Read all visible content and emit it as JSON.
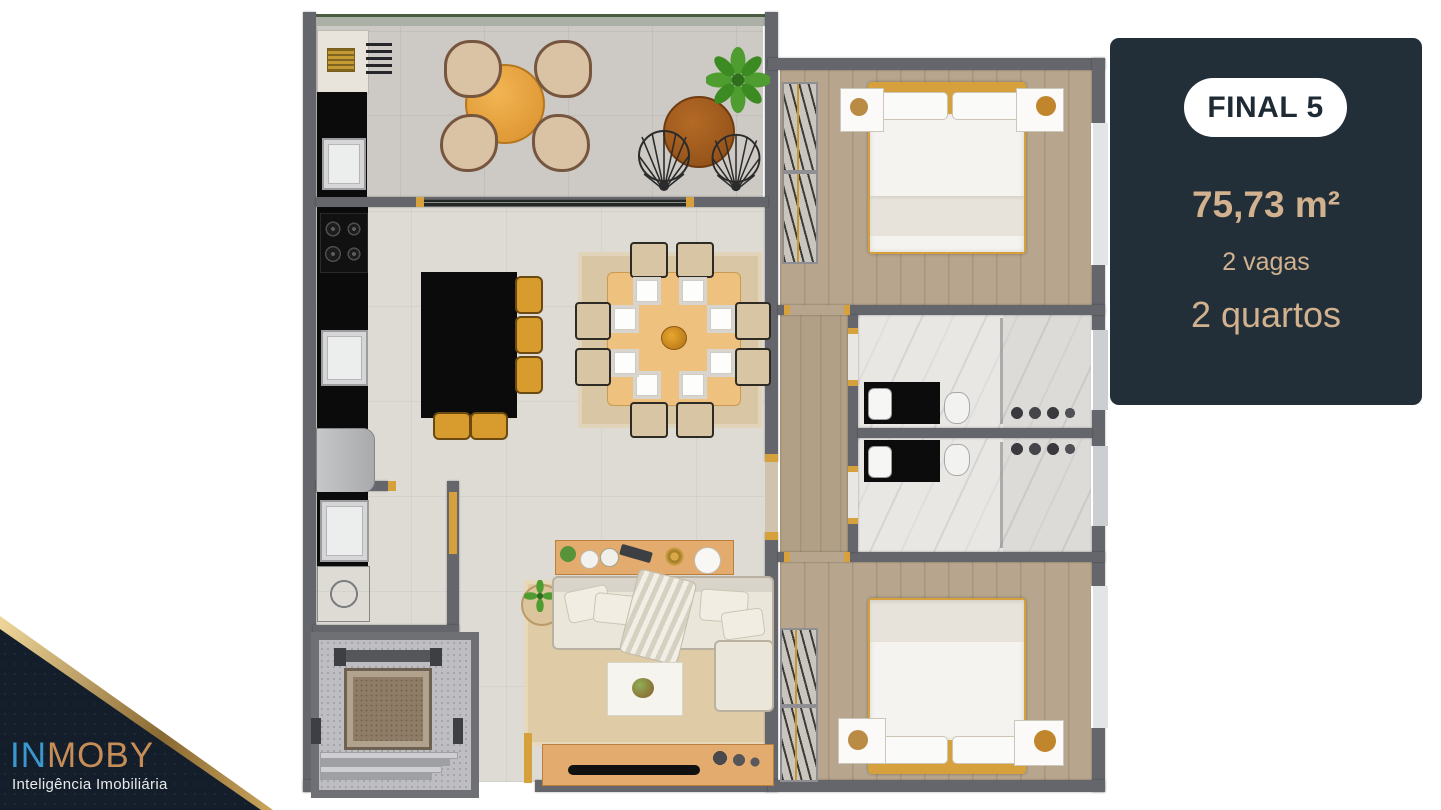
{
  "card": {
    "badge": "FINAL 5",
    "area": "75,73 m²",
    "parking": "2 vagas",
    "bedrooms": "2 quartos",
    "colors": {
      "background": "#222f39",
      "text": "#d2b28e",
      "badge_bg": "#ffffff",
      "badge_text": "#1e2b35"
    }
  },
  "brand": {
    "prefix": "IN",
    "suffix": "MOBY",
    "tagline": "Inteligência Imobiliária",
    "colors": {
      "prefix": "#3b97cf",
      "suffix": "#c78d56",
      "panel": "#141e2a",
      "ribbon": "#caa25c",
      "tagline": "#e9eaec"
    }
  },
  "floorplan": {
    "palette": {
      "wall": "#64666c",
      "accent_gold": "#d6a13c",
      "wood_floor": "#b7a68d",
      "tile_floor": "#dedbd5",
      "balcony_floor": "#cdcac5",
      "marble_floor": "#e9e7e4",
      "rug": "#d9c6a4",
      "dining_table": "#efc17e",
      "kitchen_counter": "#0b0b0b",
      "sofa": "#ece7db",
      "wood_furniture": "#e3ab6d"
    }
  }
}
